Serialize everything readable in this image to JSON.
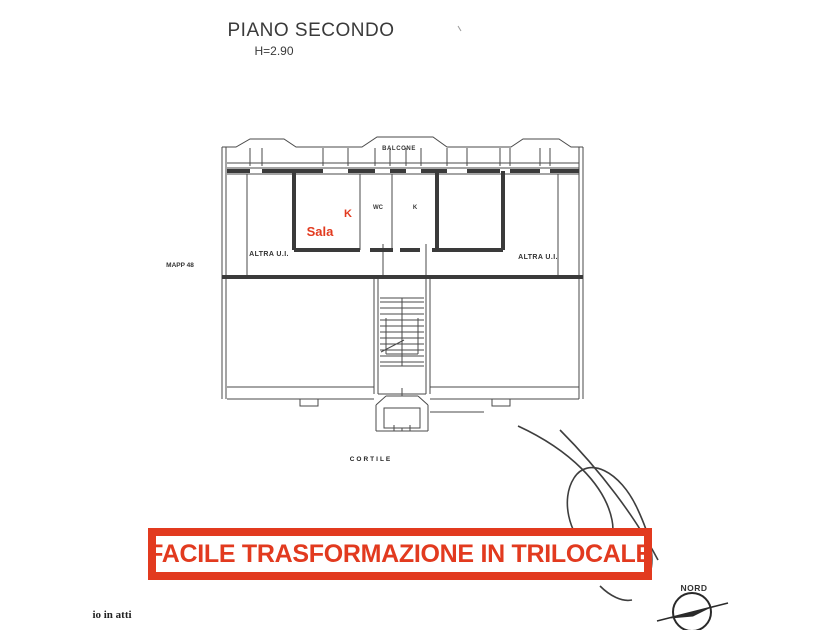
{
  "title": {
    "main": "PIANO SECONDO",
    "height_note": "H=2.90"
  },
  "plan": {
    "labels": {
      "balcone": "BALCONE",
      "sala": "Sala",
      "kitchen_red": "K",
      "wc": "WC",
      "kitchen_small": "K",
      "altra_ui_left": "ALTRA U.I.",
      "altra_ui_right": "ALTRA U.I.",
      "mapp": "MAPP 48",
      "cortile": "CORTILE"
    }
  },
  "banner": {
    "text": "FACILE TRASFORMAZIONE IN TRILOCALE",
    "color": "#e23a1f"
  },
  "compass": {
    "label": "NORD"
  },
  "footer": {
    "fragment": "io in atti"
  },
  "colors": {
    "accent_red": "#e23a1f",
    "line": "#4a4a4a",
    "wall": "#3a3a3a",
    "text": "#3d3d3d"
  }
}
